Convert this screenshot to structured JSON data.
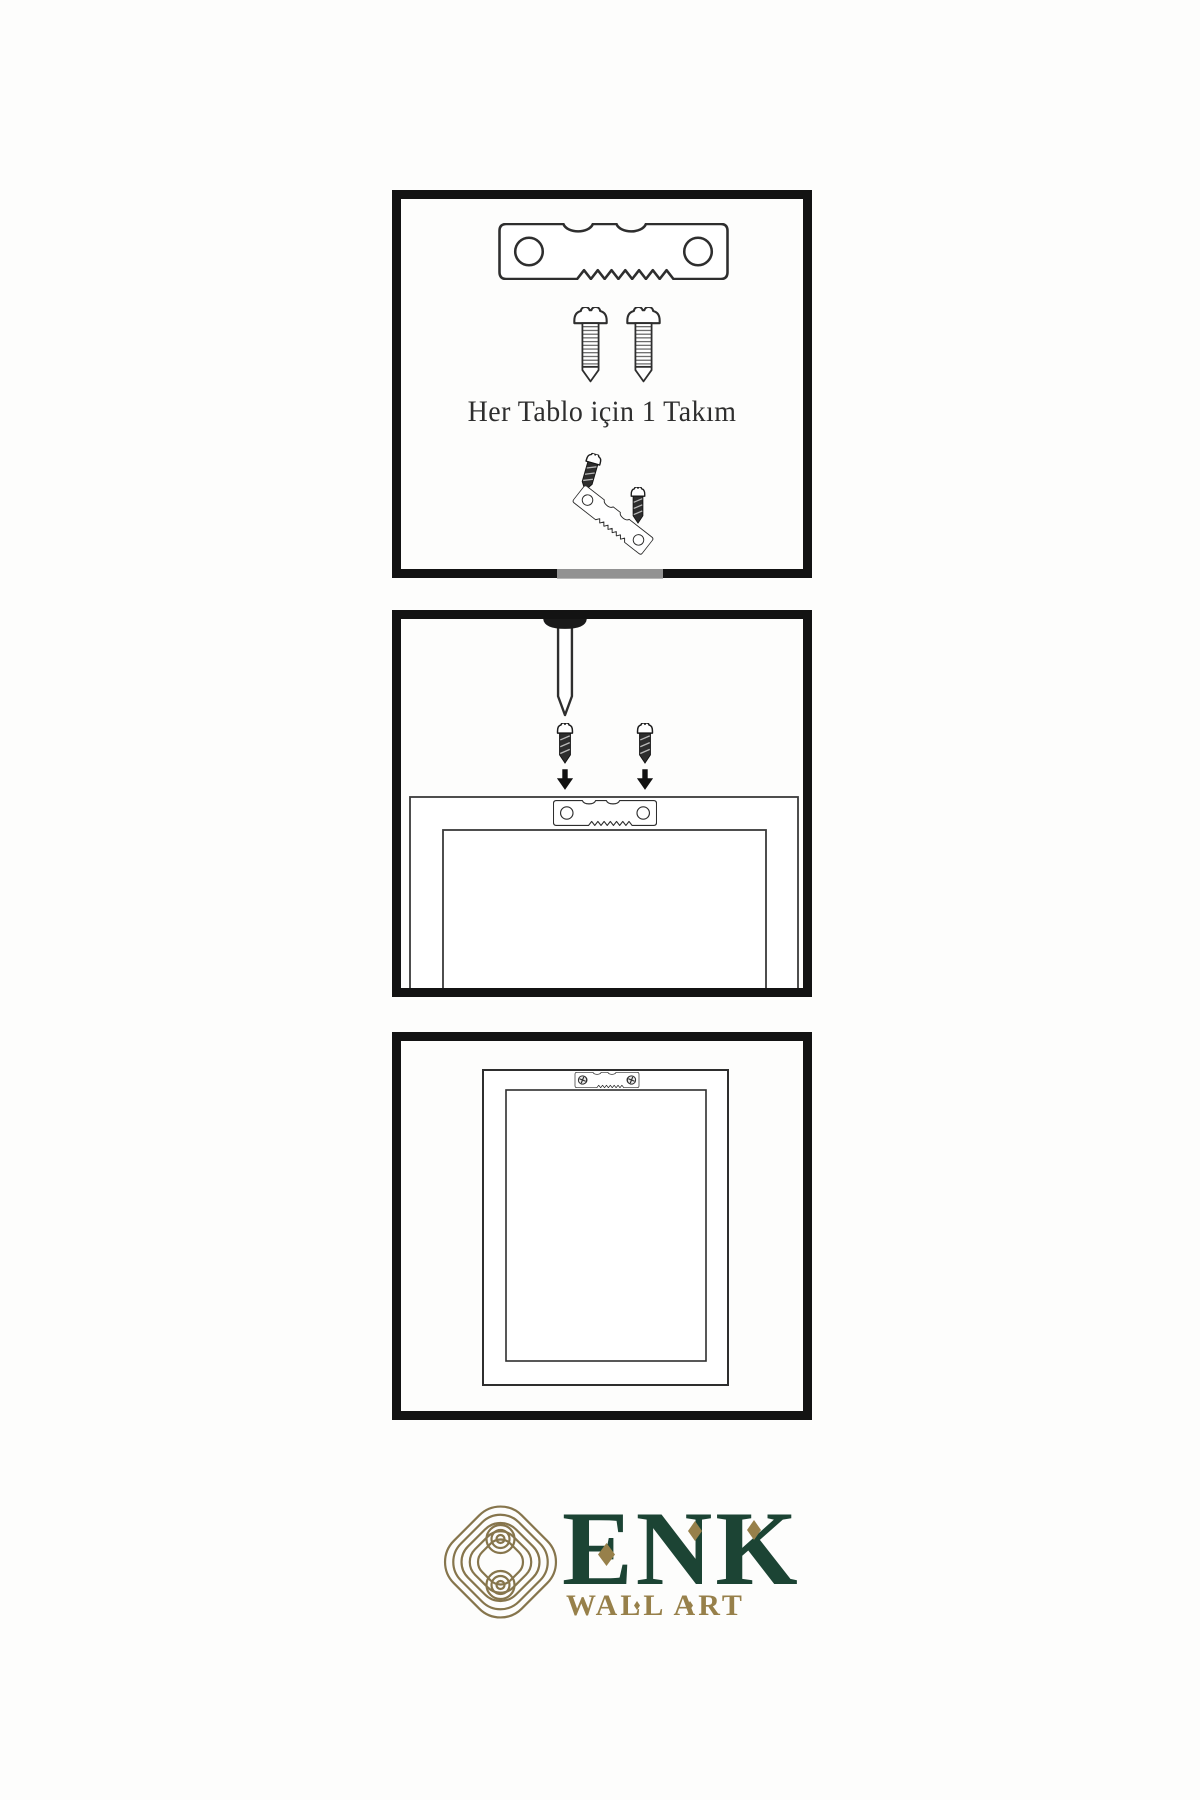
{
  "page": {
    "background_color": "#fdfdfc",
    "line_color": "#2e2e2e",
    "type": "wall-art-hanging-instruction-sheet"
  },
  "panels": [
    {
      "name": "hardware-kit",
      "caption": "Her Tablo için 1 Takım",
      "icons": [
        "sawtooth-hanger",
        "screw",
        "screw",
        "screw-dark",
        "tilted-sawtooth-hanger",
        "screw-dark"
      ]
    },
    {
      "name": "attach-hanger-to-frame",
      "icons": [
        "wall-nail",
        "screw-dark",
        "screw-dark",
        "down-arrow",
        "down-arrow",
        "sawtooth-hanger",
        "frame-back"
      ]
    },
    {
      "name": "mounted-frame",
      "icons": [
        "sawtooth-hanger-installed",
        "phillips-screw",
        "phillips-screw",
        "frame-back"
      ]
    }
  ],
  "logo": {
    "brand": "ENK",
    "subtitle": "WALL ART",
    "emblem": "interlocking-knot-emblem",
    "green": "#1c4434",
    "gold": "#97804a"
  }
}
